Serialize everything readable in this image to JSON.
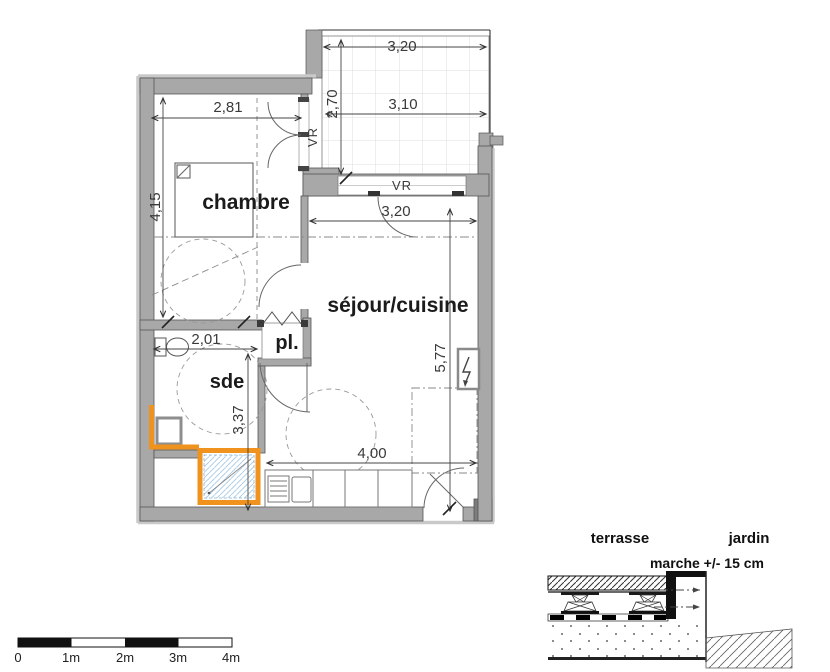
{
  "plan": {
    "room_labels": {
      "chambre": "chambre",
      "sejour": "séjour/cuisine",
      "sde": "sde",
      "placard": "pl."
    },
    "dimensions": {
      "terrace_top": "3,20",
      "terrace_inner": "3,10",
      "terrace_depth": "2,70",
      "chambre_width": "2,81",
      "chambre_length": "4,15",
      "sejour_width": "3,20",
      "sejour_length": "5,77",
      "sde_width": "2,01",
      "sde_length": "3,37",
      "kitchen_run": "4,00"
    },
    "shutters": {
      "chambre_vr": "VR",
      "sejour_vr": "VR"
    }
  },
  "section_detail": {
    "terrasse_label": "terrasse",
    "jardin_label": "jardin",
    "step_note": "marche +/- 15 cm"
  },
  "scale_bar": {
    "labels": [
      "0",
      "1m",
      "2m",
      "3m",
      "4m"
    ]
  },
  "colors": {
    "wall_gray": "#a8a8a8",
    "highlight_orange": "#f0921e",
    "shower_blue": "#a5c8e2"
  }
}
